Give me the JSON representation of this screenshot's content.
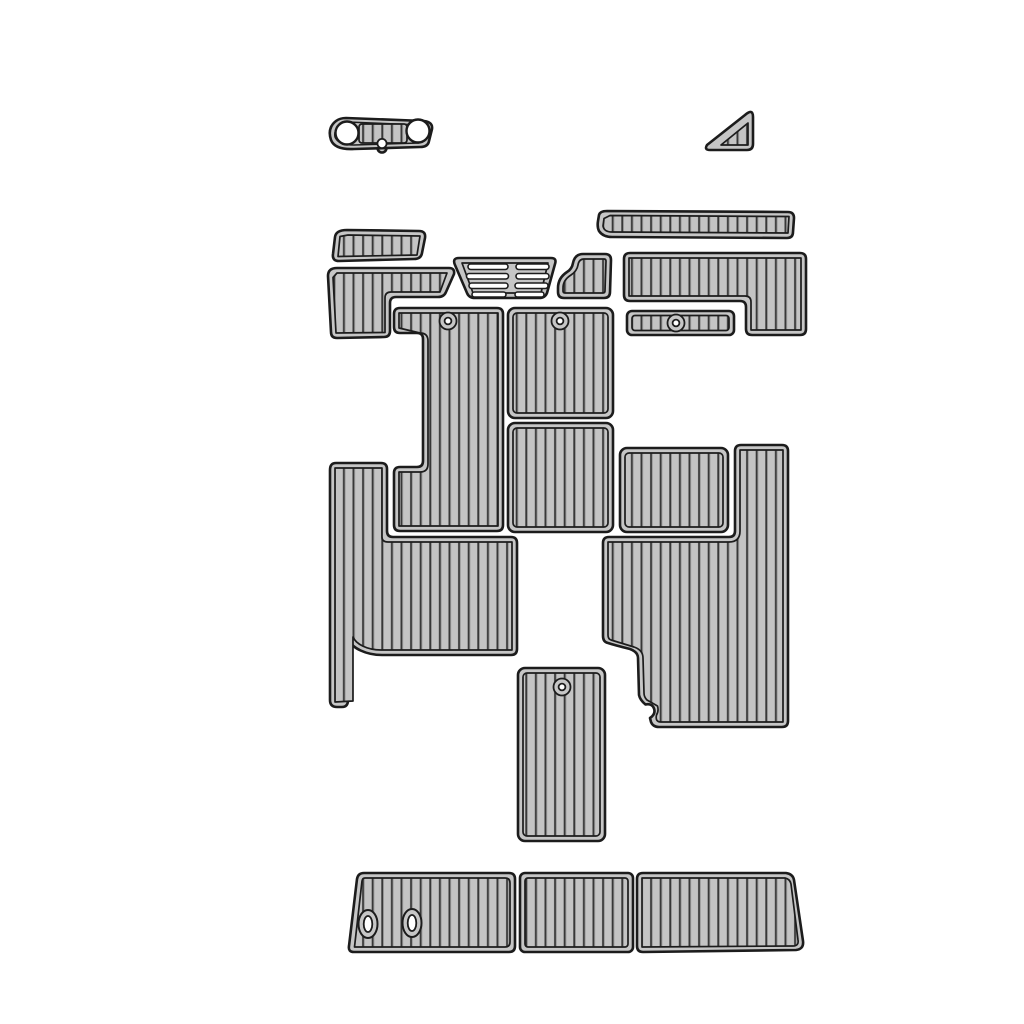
{
  "image": {
    "kind": "product-photo",
    "subject": "EVA foam faux-teak boat decking pad set, gray with black grooves, shown as exploded kit layout on white background",
    "text_content": "none"
  },
  "colors": {
    "bg": "#ffffff",
    "pad": "#c6c6c6",
    "plank": "#c4c4c4",
    "groove": "#383838",
    "groove-hi": "#9a9a9a",
    "line": "#1c1c1c"
  },
  "pads": [
    {
      "name": "helm-dash-pad",
      "description": "small elongated pad with two round gauge cutouts and a center notched plank strip"
    },
    {
      "name": "corner-triangle-pad",
      "description": "right-triangle pad with plank grooves"
    },
    {
      "name": "bow-left-small-pad",
      "description": "small slanted rectangular pad with vertical planks"
    },
    {
      "name": "left-step-l-pad",
      "description": "L-shaped step pad, top bar with descending left leg"
    },
    {
      "name": "center-vent-step-pad",
      "description": "trapezoid pad with two columns of four horizontal slots"
    },
    {
      "name": "fender-arch-pad",
      "description": "small pad with curved rising left edge"
    },
    {
      "name": "gunwale-top-strip-pad",
      "description": "long narrow plank strip with angled left end"
    },
    {
      "name": "right-step-l-pad",
      "description": "L-shaped pad, top bar with descending right leg"
    },
    {
      "name": "small-grommet-strip-pad",
      "description": "short strip pad with one center grommet"
    },
    {
      "name": "cockpit-left-tall-pad",
      "description": "tall pad with left-side notch and top grommet"
    },
    {
      "name": "cockpit-center-top-pad",
      "description": "rectangular pad with top grommet"
    },
    {
      "name": "cockpit-center-bottom-pad",
      "description": "rectangular pad"
    },
    {
      "name": "cockpit-right-mid-pad",
      "description": "wide rectangular pad"
    },
    {
      "name": "port-floor-large-pad",
      "description": "large floor pad with upper-left column, lower-left narrow leg and chamfer cutout"
    },
    {
      "name": "starboard-floor-large-pad",
      "description": "large floor pad with upper-right column and curved lower-left cutout with notch"
    },
    {
      "name": "engine-hatch-pad",
      "description": "vertical rectangular pad with top grommet"
    },
    {
      "name": "swim-platform-pad-left",
      "description": "platform section with slanted left end and two oval cleat cutouts"
    },
    {
      "name": "swim-platform-pad-center",
      "description": "rectangular platform section"
    },
    {
      "name": "swim-platform-pad-right",
      "description": "platform section with slanted right end"
    }
  ],
  "counts": {
    "pieces": 19,
    "grommets": 4,
    "round_cutouts": 2,
    "oval_cutouts": 2,
    "slots": 8
  }
}
